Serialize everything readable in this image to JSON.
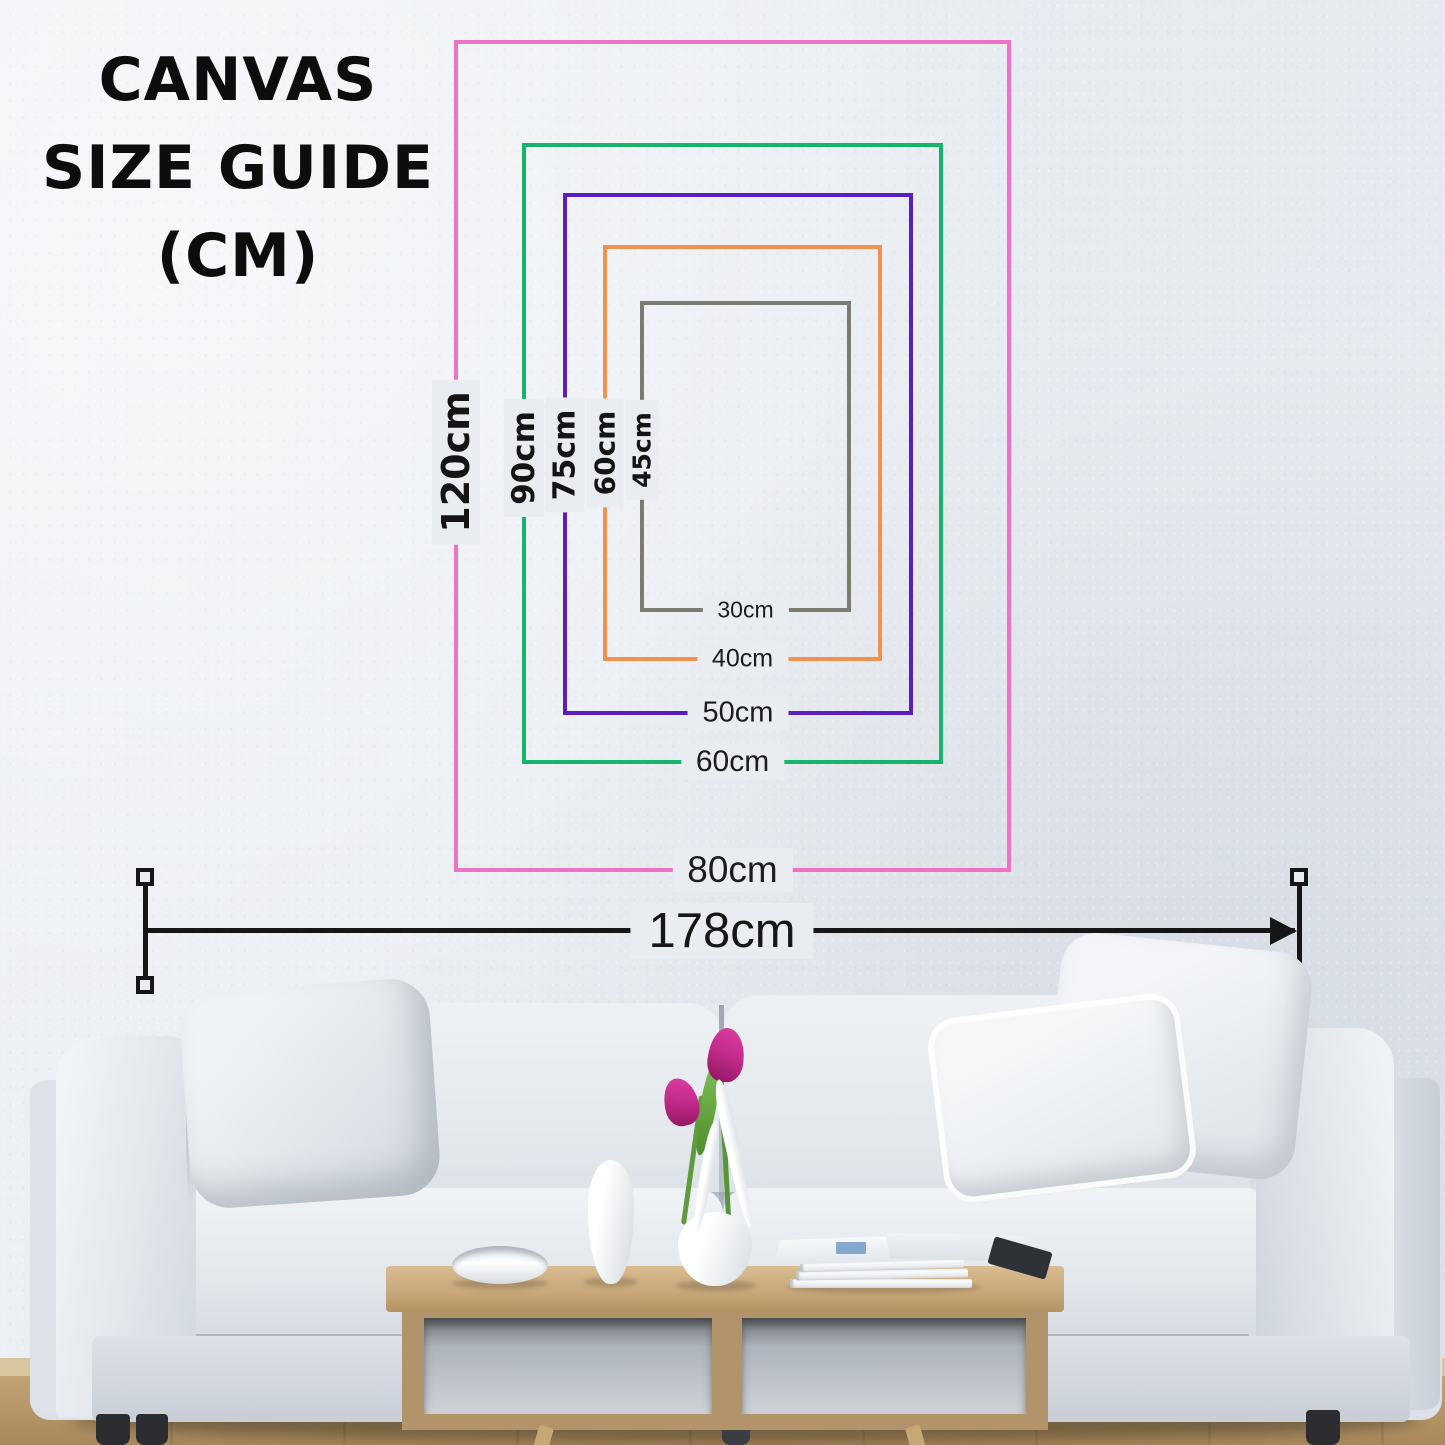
{
  "title": {
    "lines": [
      "CANVAS",
      "SIZE GUIDE",
      "(CM)"
    ]
  },
  "size_guide": {
    "unit": "cm",
    "canvases": [
      {
        "height_label": "120cm",
        "width_label": "80cm",
        "color": "#ef73c4"
      },
      {
        "height_label": "90cm",
        "width_label": "60cm",
        "color": "#17b46c"
      },
      {
        "height_label": "75cm",
        "width_label": "50cm",
        "color": "#5a1ec0"
      },
      {
        "height_label": "60cm",
        "width_label": "40cm",
        "color": "#f1914f"
      },
      {
        "height_label": "45cm",
        "width_label": "30cm",
        "color": "#7b7b6f"
      }
    ]
  },
  "sofa_measurement": {
    "width_label": "178cm"
  },
  "colors": {
    "wall": "#e9edf2",
    "text": "#141414",
    "measure_line": "#161616",
    "table_wood": "#c8a97c",
    "floor_wood": "#b8976a",
    "sofa_fabric": "#e6eaee",
    "tulip": "#c52c8c"
  }
}
